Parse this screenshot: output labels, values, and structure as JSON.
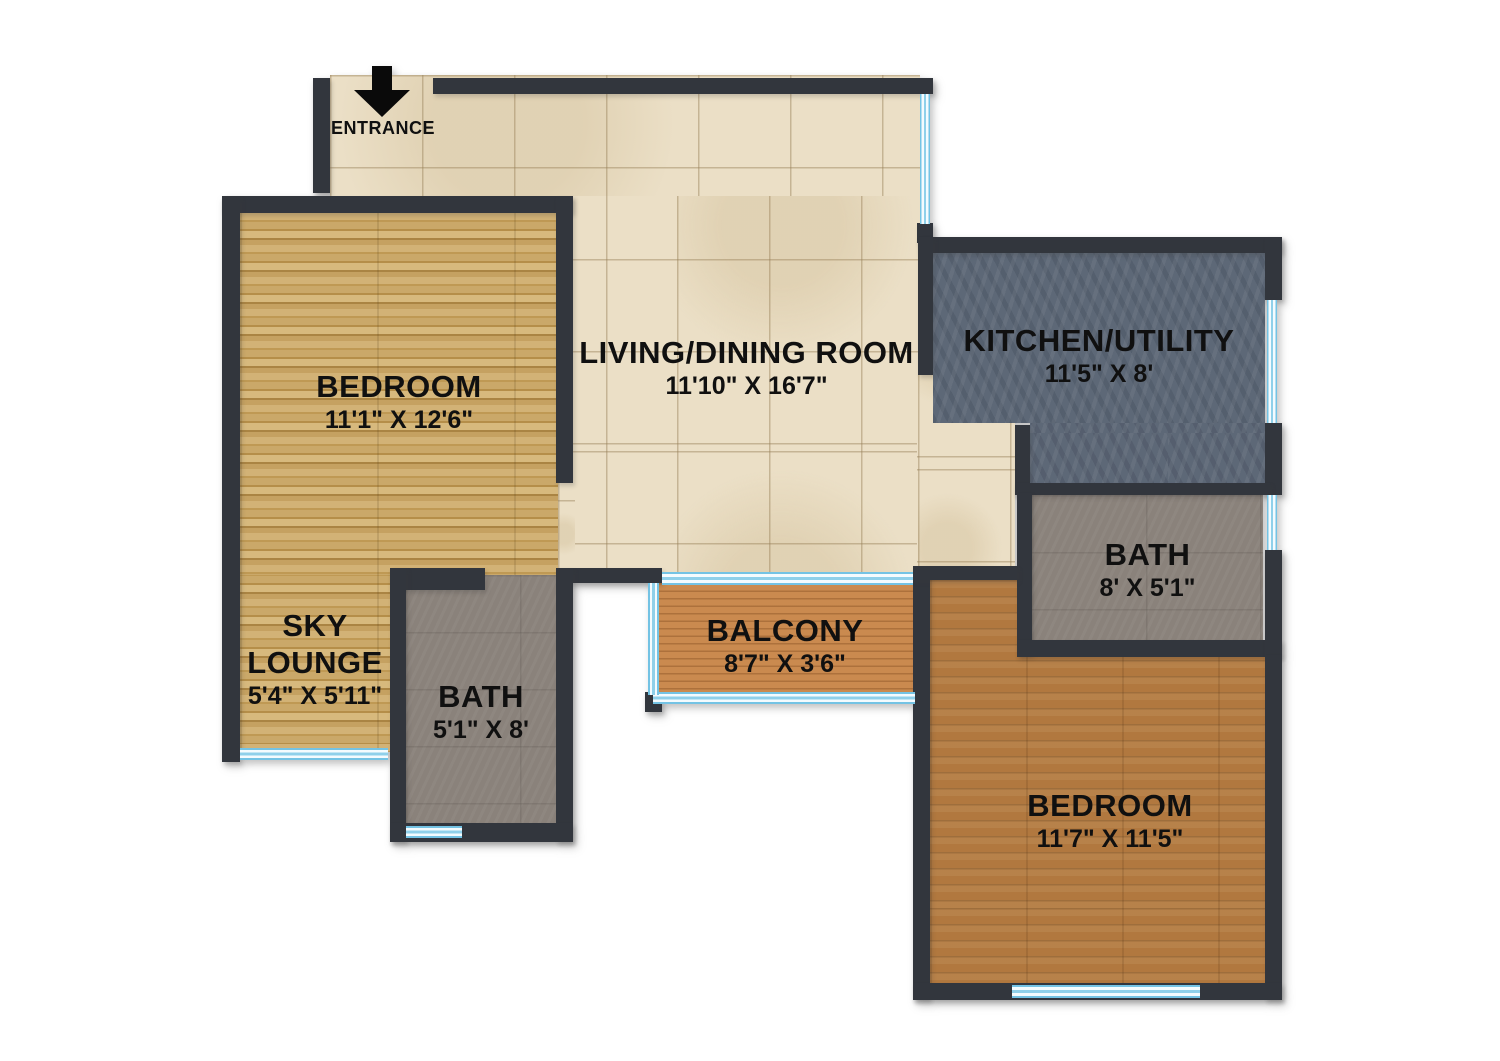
{
  "entrance": {
    "label": "ENTRANCE"
  },
  "rooms": {
    "living": {
      "name": "LIVING/DINING ROOM",
      "dims": "11'10\" X 16'7\""
    },
    "bedroom1": {
      "name": "BEDROOM",
      "dims": "11'1\" X 12'6\""
    },
    "kitchen": {
      "name": "KITCHEN/UTILITY",
      "dims": "11'5\" X 8'"
    },
    "bath1": {
      "name": "BATH",
      "dims": "8' X 5'1\""
    },
    "skylounge": {
      "name": "SKY LOUNGE",
      "dims": "5'4\" X 5'11\""
    },
    "bath2": {
      "name": "BATH",
      "dims": "5'1\" X 8'"
    },
    "balcony": {
      "name": "BALCONY",
      "dims": "8'7\" X 3'6\""
    },
    "bedroom2": {
      "name": "BEDROOM",
      "dims": "11'7\" X 11'5\""
    }
  },
  "colors": {
    "wall": "#32363d",
    "tile_floor": "#ebdfc6",
    "light_wood_floor": "#c6a262",
    "slate_floor": "#5d6877",
    "bath_floor": "#8a827b",
    "balcony_deck": "#ca8a4f",
    "brown_wood_floor": "#b1783f",
    "window": "#74c3e4",
    "label_text": "#101010"
  }
}
